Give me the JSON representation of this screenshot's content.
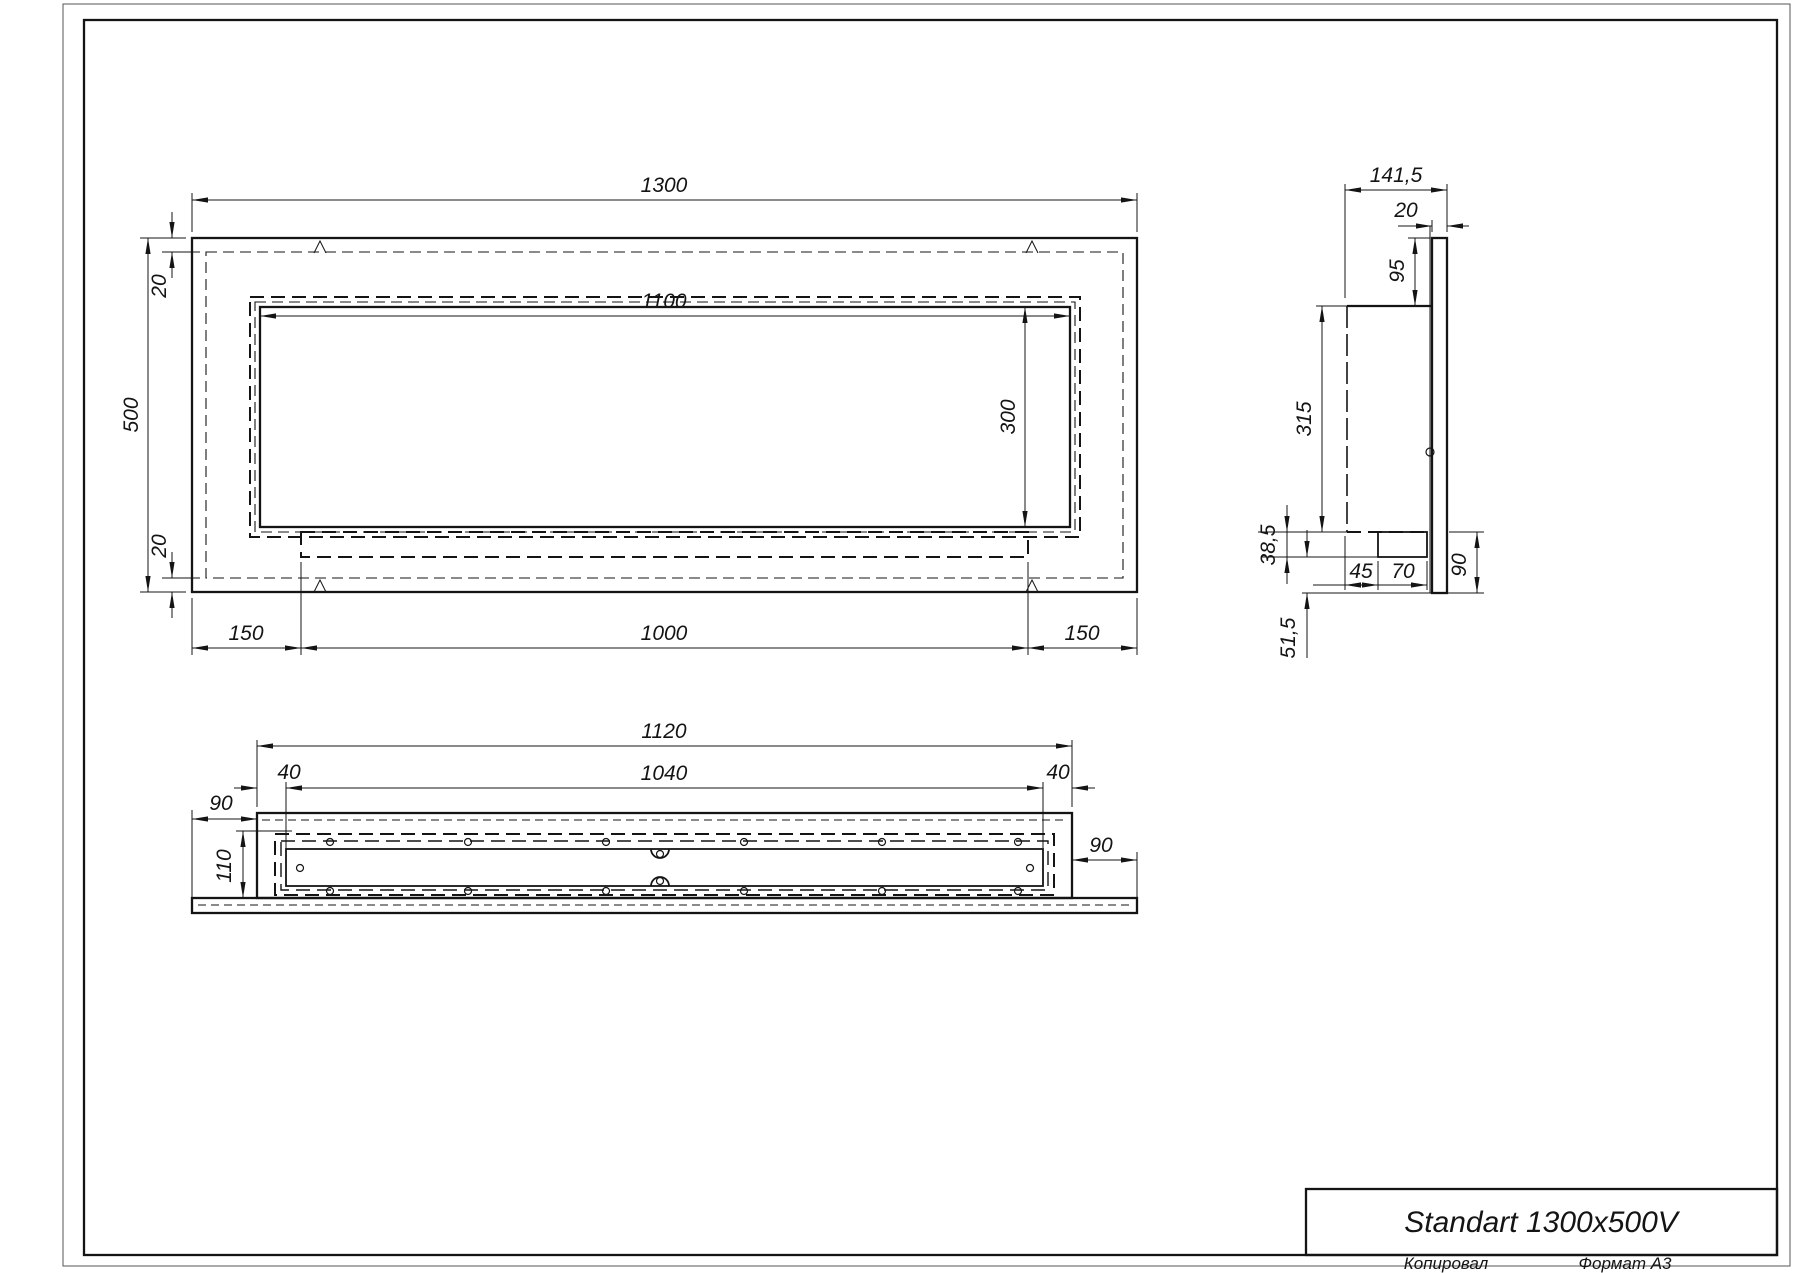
{
  "title_block": {
    "product_name": "Standart 1300x500V",
    "copied_by_label": "Копировал",
    "format_label": "Формат А3"
  },
  "front_view": {
    "dims": {
      "overall_width": "1300",
      "overall_height": "500",
      "top_inset": "20",
      "bottom_inset": "20",
      "opening_width": "1100",
      "opening_height": "300",
      "left_margin": "150",
      "center_span": "1000",
      "right_margin": "150"
    }
  },
  "side_view": {
    "dims": {
      "overall_depth": "141,5",
      "panel_thickness": "20",
      "panel_top_overhang": "95",
      "body_height": "315",
      "tray_depth": "38,5",
      "below_tray": "51,5",
      "tray_offset": "45",
      "tray_width": "70",
      "panel_bottom_overhang": "90"
    }
  },
  "plan_view": {
    "dims": {
      "body_width": "1120",
      "slot_width": "1040",
      "slot_margin_left": "40",
      "slot_margin_right": "40",
      "flange_left": "90",
      "flange_right": "90",
      "cavity_depth": "110"
    }
  }
}
